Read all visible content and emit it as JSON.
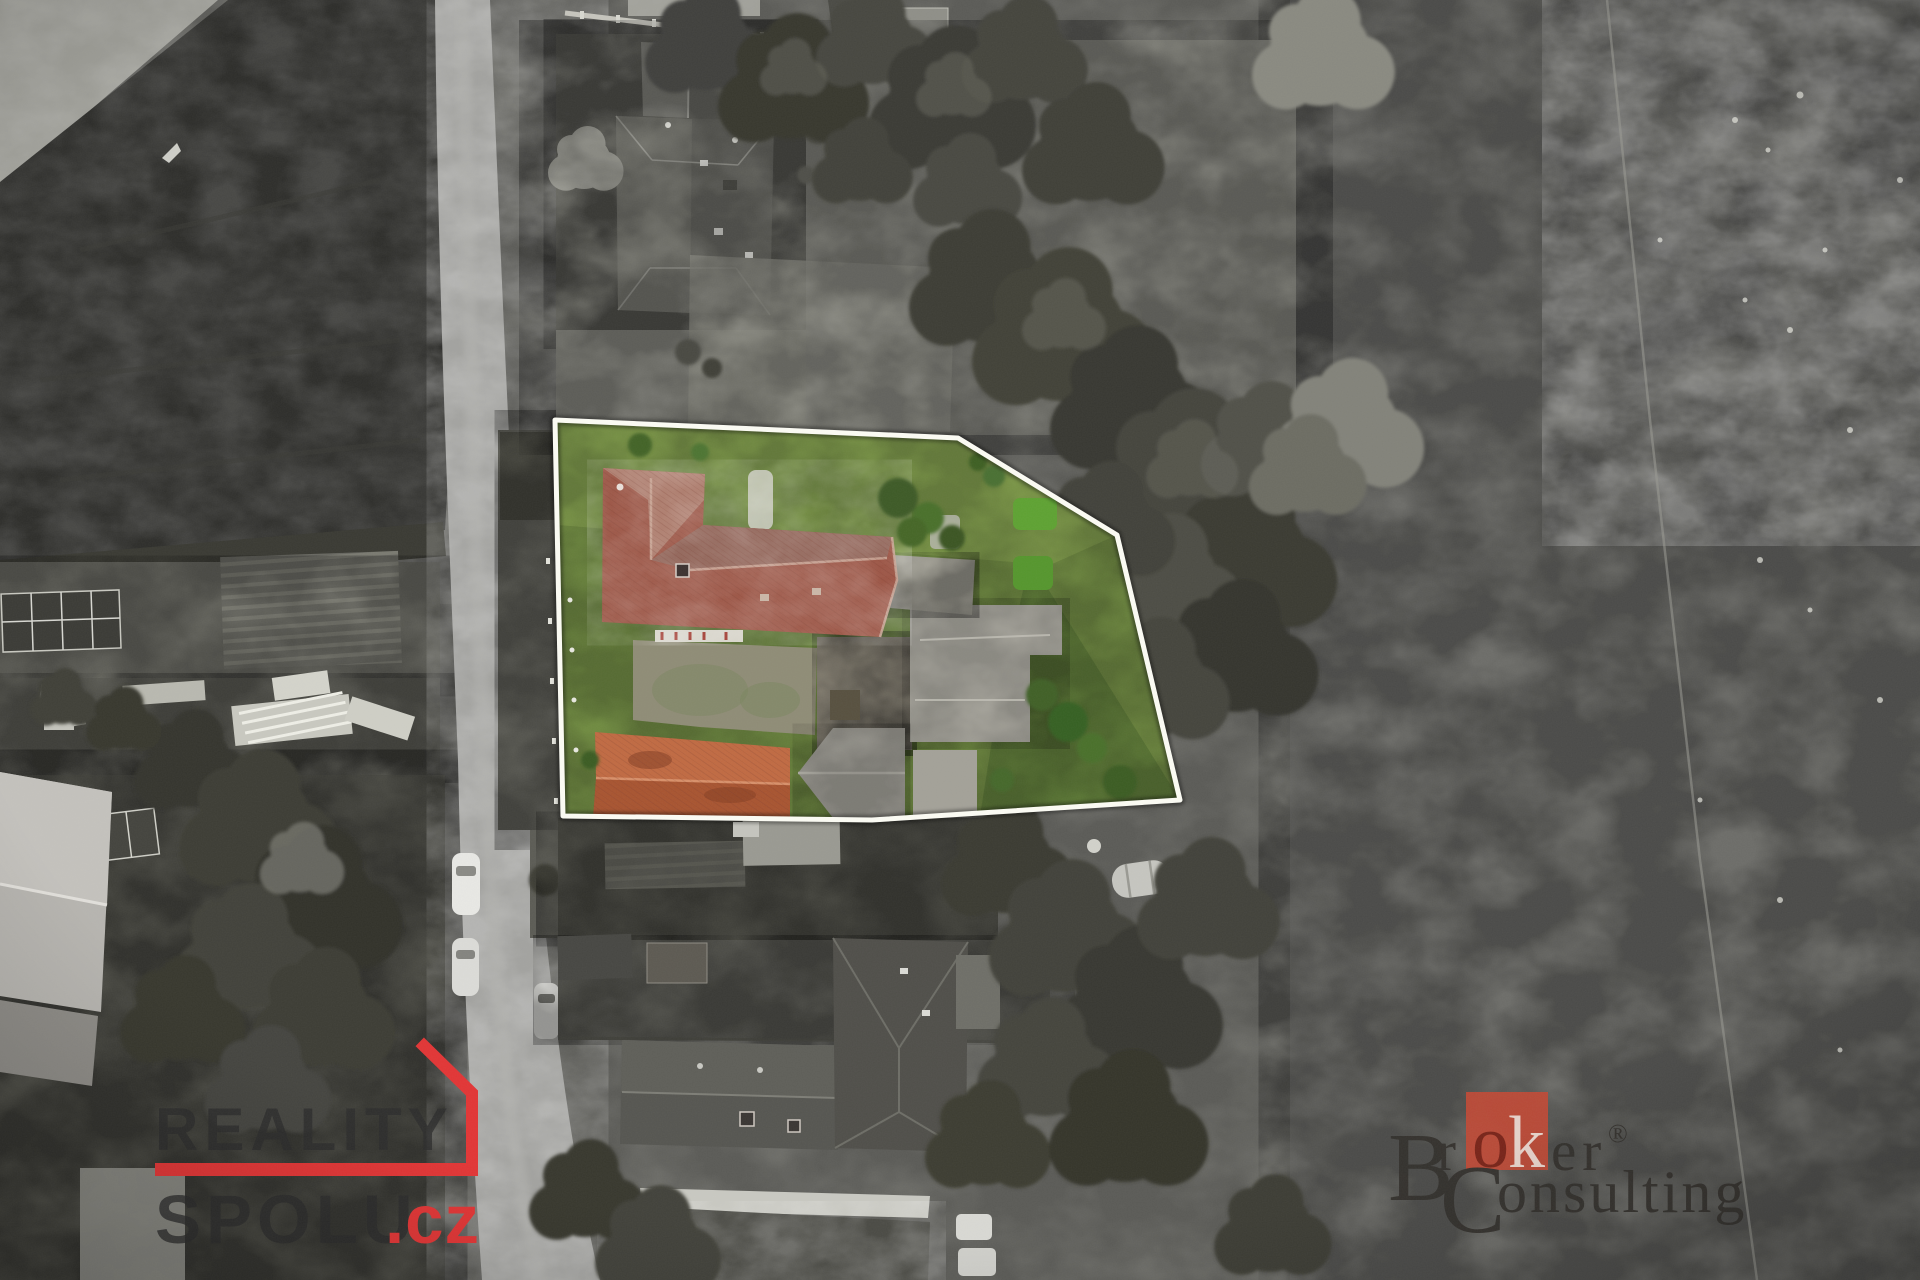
{
  "watermarks": {
    "reality_spolu": {
      "word_top": "REALITY",
      "word_bottom": "SPOLU",
      "domain_suffix": ".cz",
      "accent_red": "#e23535",
      "letter_color": "rgba(43,43,43,0.78)"
    },
    "broker_consulting": {
      "b_initial": "B",
      "r_lower": "r",
      "square_o": "o",
      "square_k": "k",
      "er_lower": "er",
      "registered_mark": "®",
      "c_initial": "C",
      "onsulting_lower": "onsulting",
      "square_red": "#c14a36",
      "text_color": "#33302c",
      "o_color": "#7c2014",
      "k_color": "#f3ded5"
    }
  },
  "scene": {
    "palette": {
      "boundary_stroke": "#fcfcf4",
      "lawn_green": "#6f8a40",
      "lawn_green_light": "#7e9a49",
      "lawn_green_dark": "#5d7a36",
      "hedge_green": "#5ea232",
      "roof_red_north": "#94685c",
      "roof_red_south": "#9c5545",
      "roof_red_wing": "#ad7b6b",
      "barn_orange_north": "#c06a42",
      "barn_orange_south": "#a85430",
      "courtyard_tan": "#8f8c76",
      "field_gray": "#6f6f6b",
      "road_gray": "#a3a3a0",
      "dark_field": "#2e2e2b"
    }
  }
}
